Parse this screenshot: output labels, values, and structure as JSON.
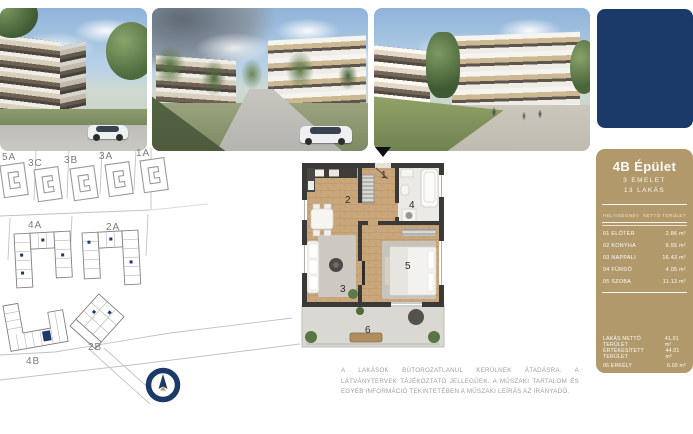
{
  "photos": [
    {
      "name": "exterior-render-corner-building"
    },
    {
      "name": "exterior-render-street-view"
    },
    {
      "name": "exterior-render-courtyard"
    }
  ],
  "brand_block": {
    "color": "#1c3a69"
  },
  "site_plan": {
    "labels": {
      "b5a": "5A",
      "b3c": "3C",
      "b3b": "3B",
      "b3a": "3A",
      "b1a": "1A",
      "b4a": "4A",
      "b2a": "2A",
      "b4b": "4B",
      "b2b": "2B"
    },
    "highlight_color": "#1c3a69"
  },
  "floor_plan": {
    "rooms": [
      {
        "number": "1"
      },
      {
        "number": "2"
      },
      {
        "number": "3"
      },
      {
        "number": "4"
      },
      {
        "number": "5"
      },
      {
        "number": "6"
      }
    ]
  },
  "info_panel": {
    "title": "4B Épület",
    "subtitle_floors": "3 EMELET",
    "subtitle_units": "13 LAKÁS",
    "table": {
      "header_name": "HELYISÉGNÉV",
      "header_area": "NETTÓ TERÜLET",
      "rows": [
        {
          "name": "01 ELŐTÉR",
          "area": "2.86 m²"
        },
        {
          "name": "02 KONYHA",
          "area": "6.55 m²"
        },
        {
          "name": "03 NAPPALI",
          "area": "16.43 m²"
        },
        {
          "name": "04 FÜRDŐ",
          "area": "4.05 m²"
        },
        {
          "name": "05 SZOBA",
          "area": "11.13 m²"
        }
      ],
      "summary": [
        {
          "name": "LAKÁS NETTÓ TERÜLET",
          "area": "41.01 m²"
        },
        {
          "name": "ÉRTÉKESÍTETT TERÜLET",
          "area": "44.01 m²"
        },
        {
          "name": "06 ERKÉLY",
          "area": "6.00 m²"
        }
      ]
    },
    "bg_color": "#b1996b"
  },
  "disclaimer": "A LAKÁSOK BÚTOROZATLANUL KERÜLNEK ÁTADÁSRA. A LÁTVÁNYTERVEK TÁJÉKOZTATÓ JELLEGŰEK. A MŰSZAKI TARTALOM ÉS EGYÉB INFORMÁCIÓ TEKINTETÉBEN A MŰSZAKI LEÍRÁS AZ IRÁNYADÓ."
}
